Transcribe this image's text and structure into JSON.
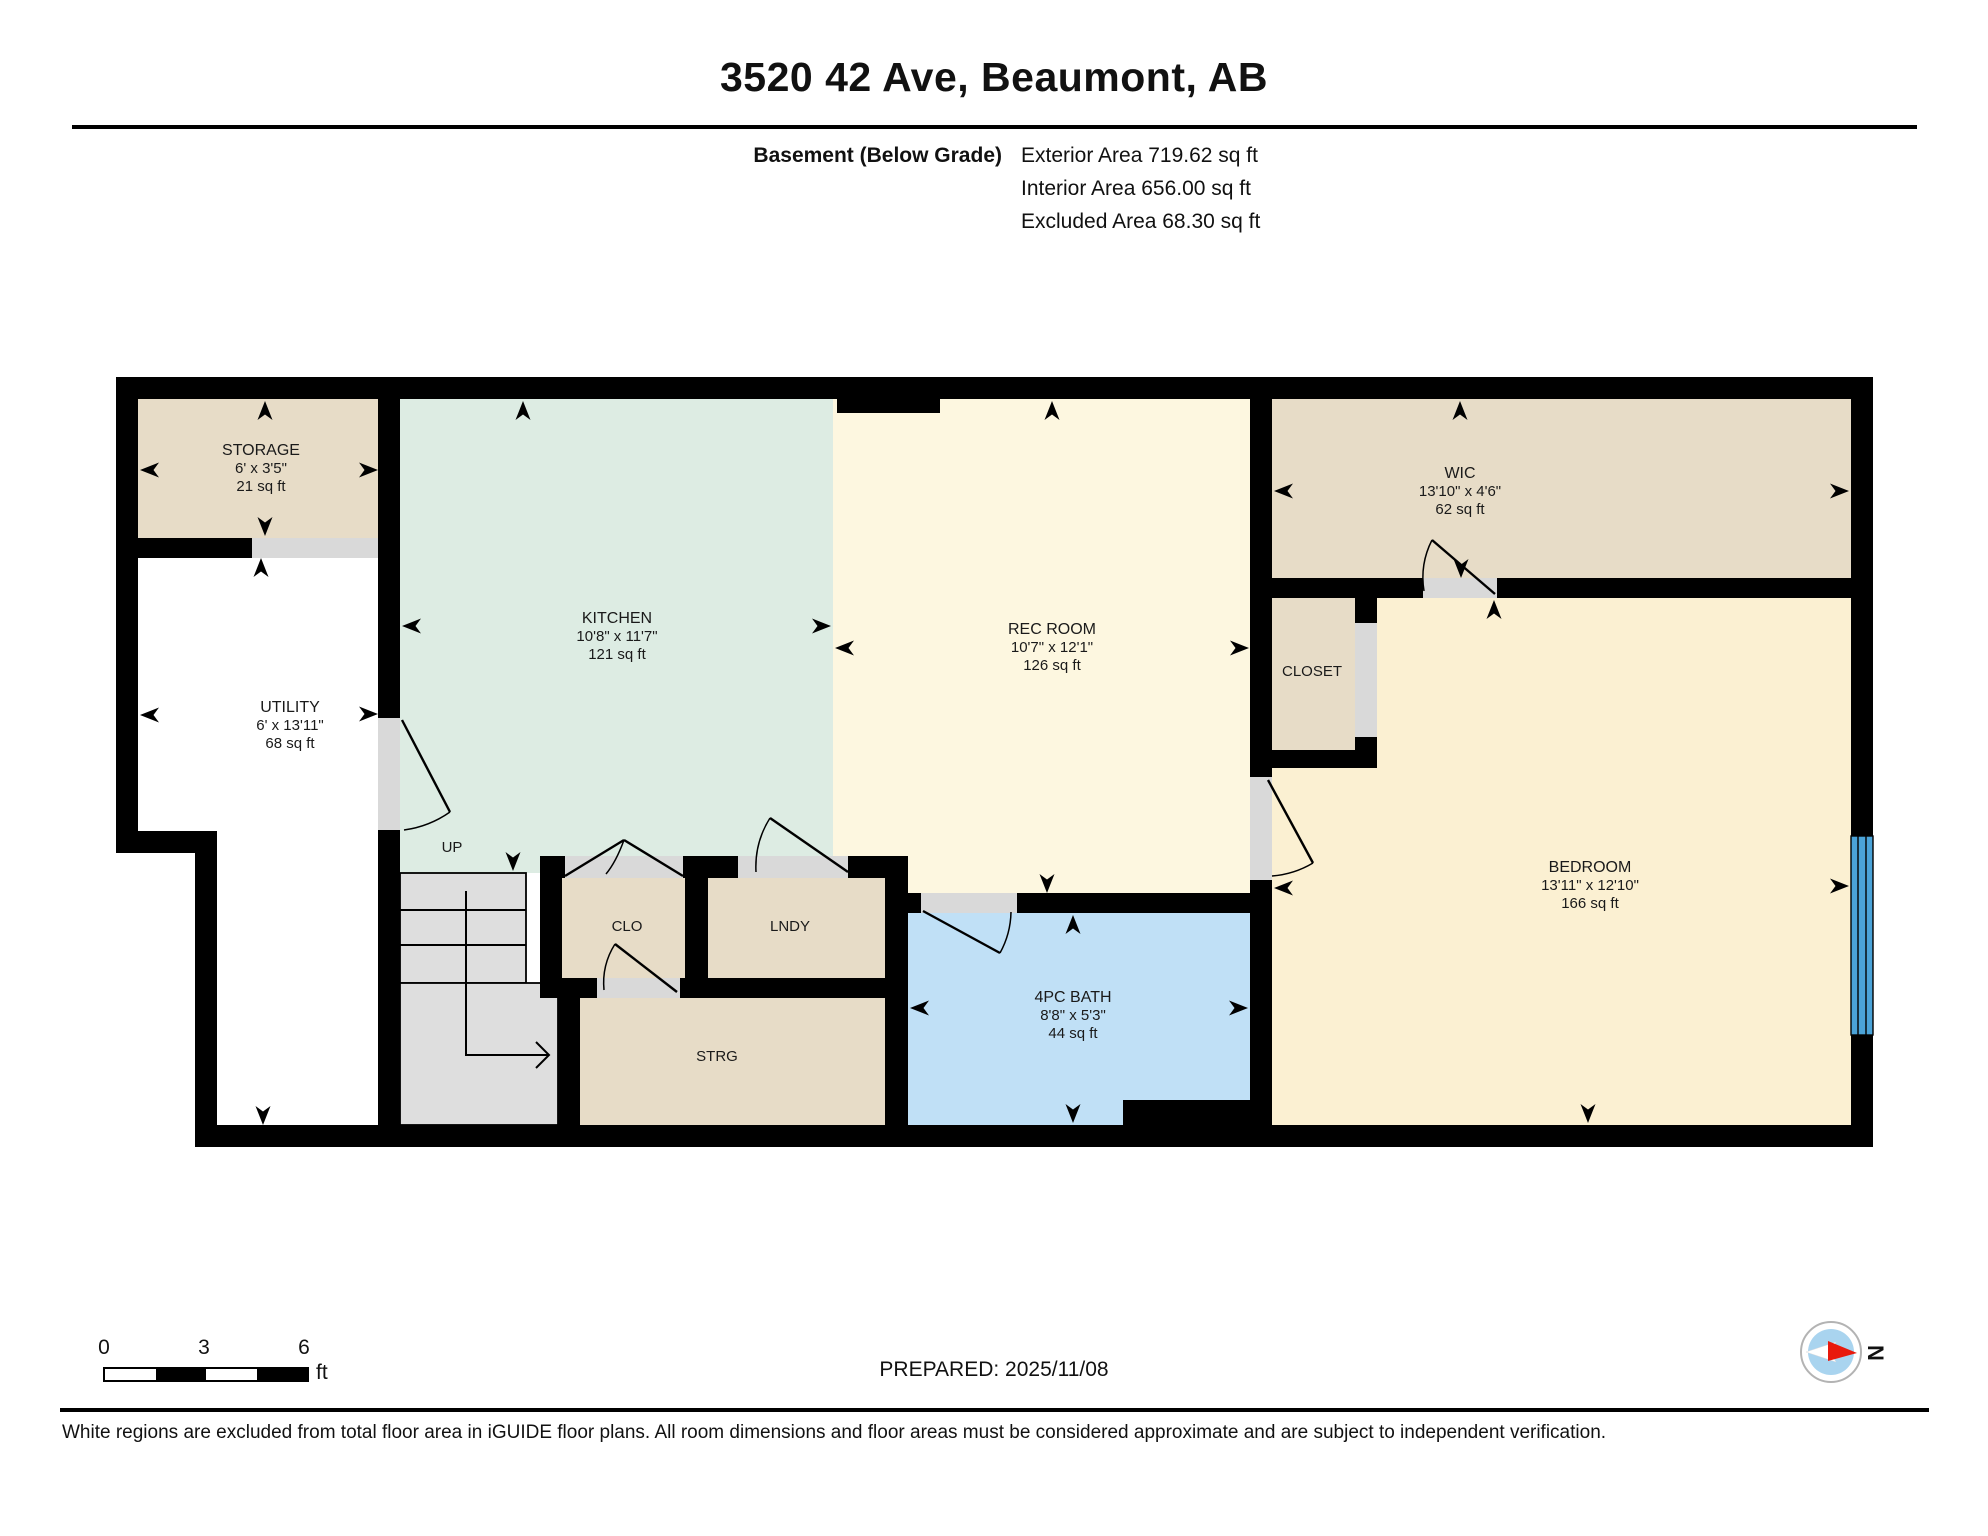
{
  "header": {
    "title": "3520 42 Ave, Beaumont, AB",
    "floor_label": "Basement (Below Grade)",
    "exterior_area": "Exterior Area 719.62 sq ft",
    "interior_area": "Interior Area 656.00 sq ft",
    "excluded_area": "Excluded Area 68.30 sq ft"
  },
  "plan": {
    "stairs_label": "UP",
    "rooms": {
      "storage": {
        "name": "STORAGE",
        "dims": "6' x 3'5\"",
        "area": "21 sq ft"
      },
      "utility": {
        "name": "UTILITY",
        "dims": "6' x 13'11\"",
        "area": "68 sq ft"
      },
      "kitchen": {
        "name": "KITCHEN",
        "dims": "10'8\" x 11'7\"",
        "area": "121 sq ft"
      },
      "rec_room": {
        "name": "REC ROOM",
        "dims": "10'7\" x 12'1\"",
        "area": "126 sq ft"
      },
      "wic": {
        "name": "WIC",
        "dims": "13'10\" x 4'6\"",
        "area": "62 sq ft"
      },
      "closet": {
        "name": "CLOSET"
      },
      "bedroom": {
        "name": "BEDROOM",
        "dims": "13'11\" x 12'10\"",
        "area": "166 sq ft"
      },
      "clo": {
        "name": "CLO"
      },
      "lndy": {
        "name": "LNDY"
      },
      "strg": {
        "name": "STRG"
      },
      "bath": {
        "name": "4PC BATH",
        "dims": "8'8\" x 5'3\"",
        "area": "44 sq ft"
      }
    }
  },
  "footer": {
    "scale": {
      "ticks": [
        "0",
        "3",
        "6"
      ],
      "unit": "ft"
    },
    "prepared": "PREPARED: 2025/11/08",
    "compass_label": "N",
    "disclaimer": "White regions are excluded from total floor area in iGUIDE floor plans. All room dimensions and floor areas must be considered approximate and are subject to independent verification."
  },
  "colors": {
    "wall": "#000000",
    "room_tan": "#e7dcc7",
    "kitchen_mint": "#ddece3",
    "rec_cream": "#fdf7e0",
    "bedroom_cream": "#fbf0d2",
    "bath_blue": "#c0e0f6",
    "door_grey": "#d9d9d9",
    "stair_grey": "#dedede",
    "window_blue": "#4ba3d8"
  }
}
